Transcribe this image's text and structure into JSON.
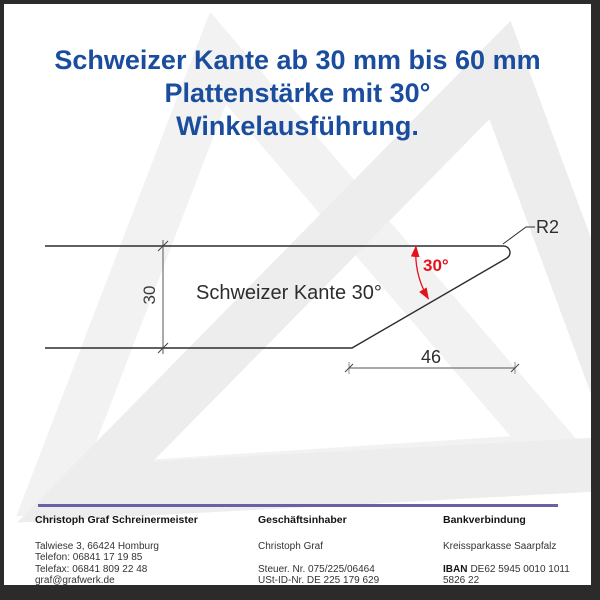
{
  "title": {
    "line1": "Schweizer Kante ab 30 mm bis 60 mm",
    "line2": "Plattenstärke mit 30°",
    "line3": "Winkelausführung."
  },
  "drawing": {
    "profile_label": "Schweizer Kante 30°",
    "thickness_dim": "30",
    "bevel_width_dim": "46",
    "angle_dim": "30°",
    "radius_label": "R2"
  },
  "footer": {
    "company": {
      "heading": "Christoph Graf Schreinermeister",
      "lines": [
        "Talwiese 3, 66424 Homburg",
        "Telefon: 06841 17 19 85",
        "Telefax: 06841 809 22 48",
        "graf@grafwerk.de"
      ]
    },
    "owner": {
      "heading": "Geschäftsinhaber",
      "name": "Christoph Graf",
      "tax_no": "Steuer. Nr. 075/225/06464",
      "vat_id": "USt-ID-Nr. DE 225 179 629"
    },
    "bank": {
      "heading": "Bankverbindung",
      "bank_name": "Kreissparkasse Saarpfalz",
      "iban_label": "IBAN",
      "iban_value": "DE62 5945 0010 1011 5826 22",
      "bic_label": "BIC",
      "bic_value": "SALADE51HOM"
    }
  },
  "colors": {
    "title_blue": "#1b4d9e",
    "dimension_red": "#e4131b",
    "separator_purple": "#6b5fa5",
    "watermark_gray": "#ededed",
    "frame_dark": "#2b2b2b"
  }
}
